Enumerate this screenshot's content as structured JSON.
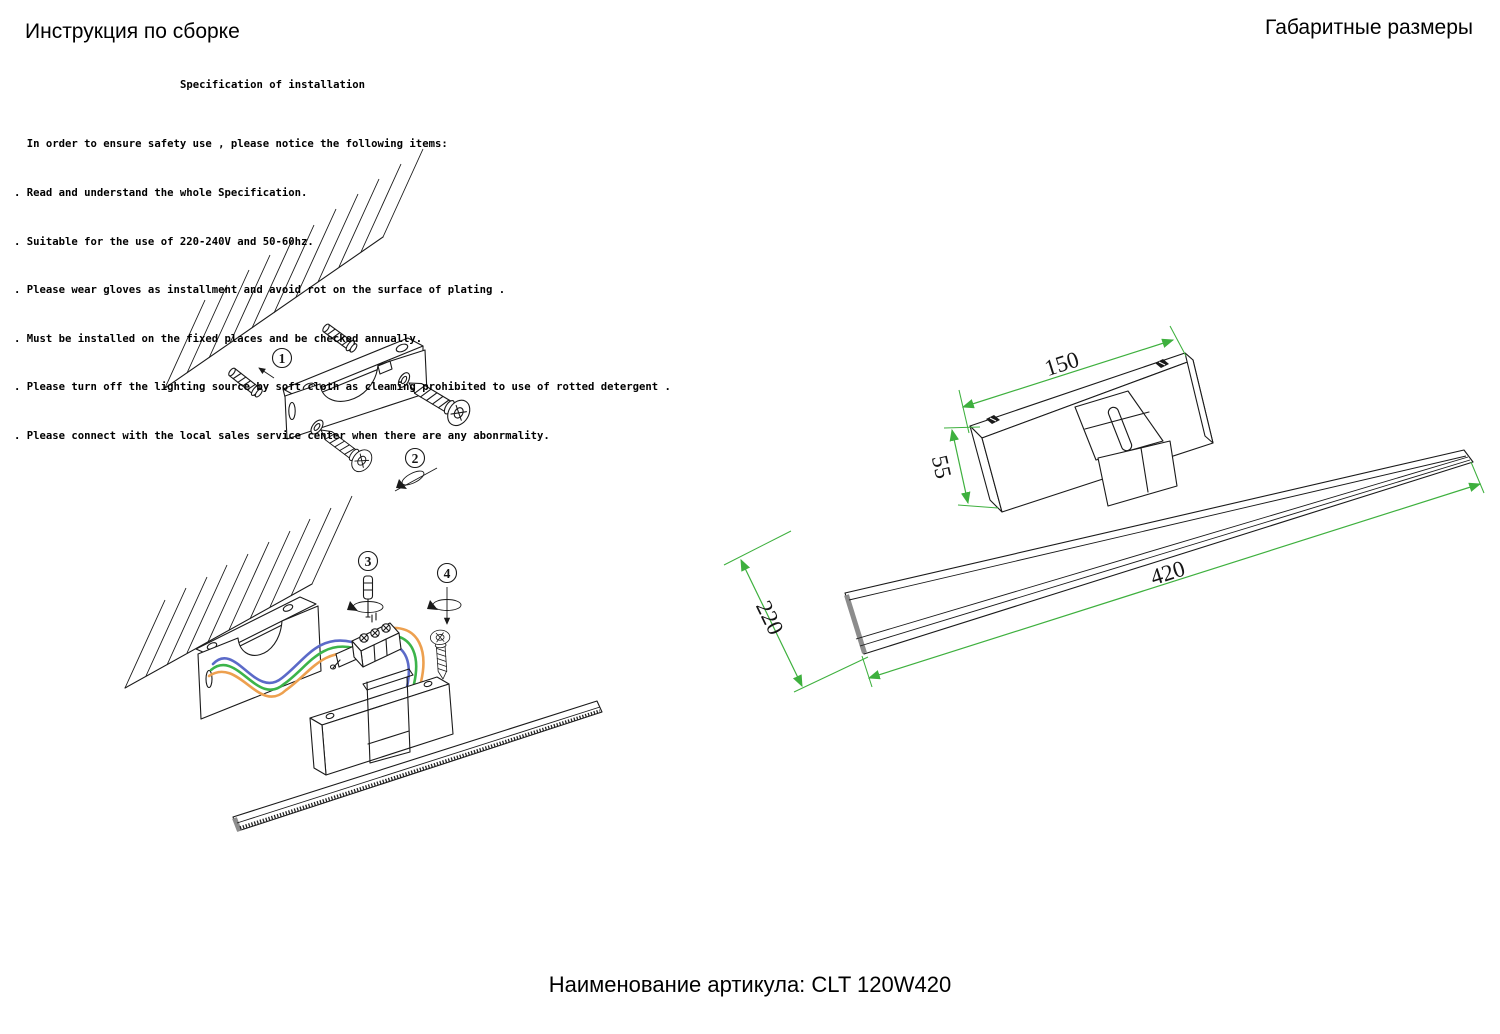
{
  "header": {
    "title_left": "Инструкция по сборке",
    "title_right": "Габаритные размеры"
  },
  "spec": {
    "heading": "Specification of installation",
    "lines": [
      "  In order to ensure safety use , please notice the following items:",
      ". Read and understand the whole Specification.",
      ". Suitable for the use of 220-240V and 50-60hz.",
      ". Please wear gloves as installment and avoid rot on the surface of plating .",
      ". Must be installed on the fixed places and be checked annually.",
      ". Please turn off the lighting source by soft cloth as cleaming prohibited to use of rotted detergent .",
      ". Please connect with the local sales service center when there are any abonrmality."
    ]
  },
  "installation": {
    "steps": [
      "1",
      "2",
      "3",
      "4"
    ]
  },
  "dimensions": {
    "bracket_length": "150",
    "bracket_height": "55",
    "bar_length": "420",
    "depth": "220"
  },
  "footer": {
    "article": "Наименование артикула: CLT 120W420"
  },
  "colors": {
    "dimension_line": "#3eb03e",
    "wire_blue": "#5b6ac8",
    "wire_green": "#3cb44a",
    "wire_orange": "#eda04f"
  }
}
